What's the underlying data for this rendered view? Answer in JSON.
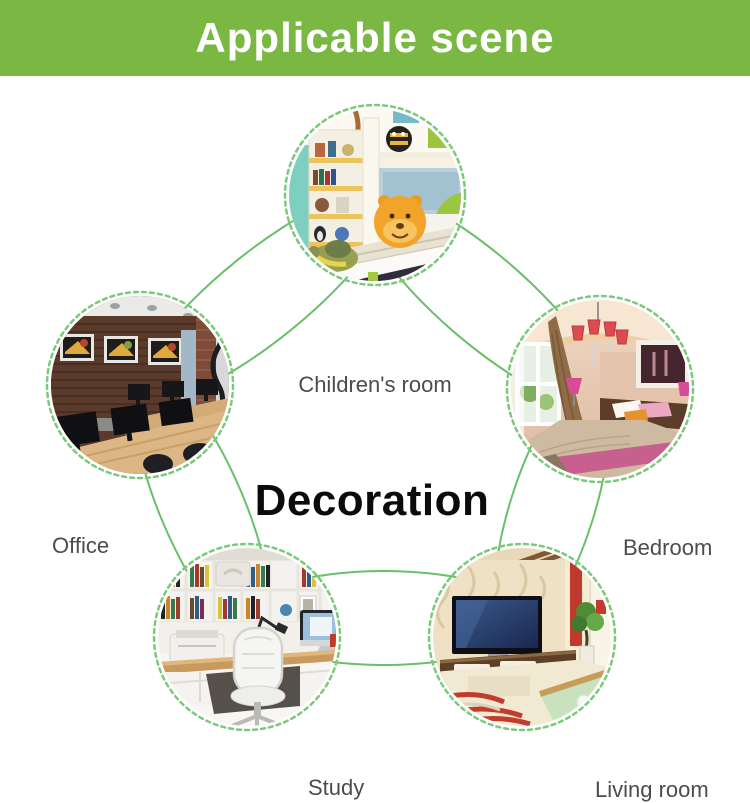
{
  "header": {
    "title": "Applicable scene",
    "bg_color": "#7ab843",
    "text_color": "#ffffff"
  },
  "center": {
    "label": "Decoration"
  },
  "diagram": {
    "line_color": "#6abf6a",
    "ring_color": "#7bc97b",
    "label_color": "#4c4c4c",
    "nodes": [
      {
        "id": "childrens-room",
        "label": "Children's room"
      },
      {
        "id": "office",
        "label": "Office"
      },
      {
        "id": "bedroom",
        "label": "Bedroom"
      },
      {
        "id": "study",
        "label": "Study"
      },
      {
        "id": "living-room",
        "label": "Living room"
      }
    ]
  }
}
